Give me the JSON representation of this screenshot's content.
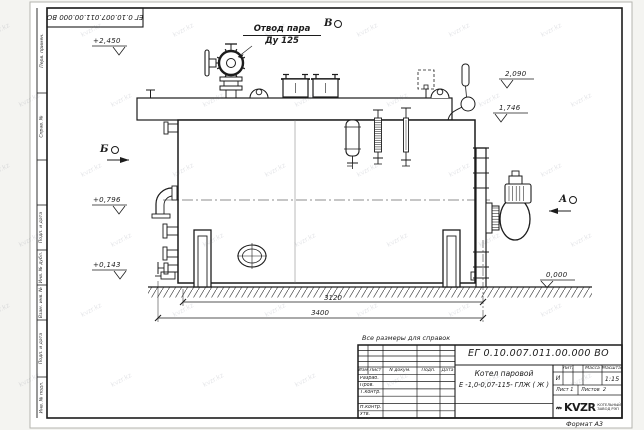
{
  "watermark": "kvzr.kz",
  "frame": {
    "top_stamp": "ЕГ 0.10.007.011.00.000  ВО",
    "format_label": "Формат А3",
    "side_labels": [
      "Перв. примен.",
      "Справ. №",
      "Подп. и дата",
      "Инв. № дубл.",
      "Взам. инв. №",
      "Подп. и дата",
      "Инв. № подл."
    ]
  },
  "drawing": {
    "callout_line1": "Отвод пара",
    "callout_line2": "Ду 125",
    "views": [
      "В",
      "Б",
      "А"
    ],
    "elevations": [
      "+2,450",
      "2,090",
      "1,746",
      "+0,796",
      "+0,143",
      "0,000"
    ],
    "dimensions": [
      "3120",
      "3400"
    ],
    "note": "Все размеры для справок"
  },
  "title_block": {
    "designation": "ЕГ 0.10.007.011.00.000  ВО",
    "product_name": "Котел паровой",
    "product_type": "Е -1,0-0,07-115- ГЛЖ ( Ж )",
    "col_izm": "Изм",
    "col_list": "Лист",
    "col_doc": "N докум.",
    "col_podp": "Подп.",
    "col_data": "Дата",
    "row_razrab": "Разраб.",
    "row_prov": "Пров.",
    "row_tkontr": "Т.контр.",
    "row_nkontr": "Н.контр.",
    "row_utv": "Утв.",
    "lit_label": "Лит.",
    "lit_value": "И",
    "mass_label": "Масса",
    "scale_label": "Масштаб",
    "scale_value": "1:15",
    "sheet_label": "Лист",
    "sheet_value": "1",
    "sheets_label": "Листов",
    "sheets_value": "2",
    "company_logo": "KVZR",
    "company_line1": "КОТЕЛЬНЫЙ",
    "company_line2": "ЗАВОД РЭП"
  }
}
